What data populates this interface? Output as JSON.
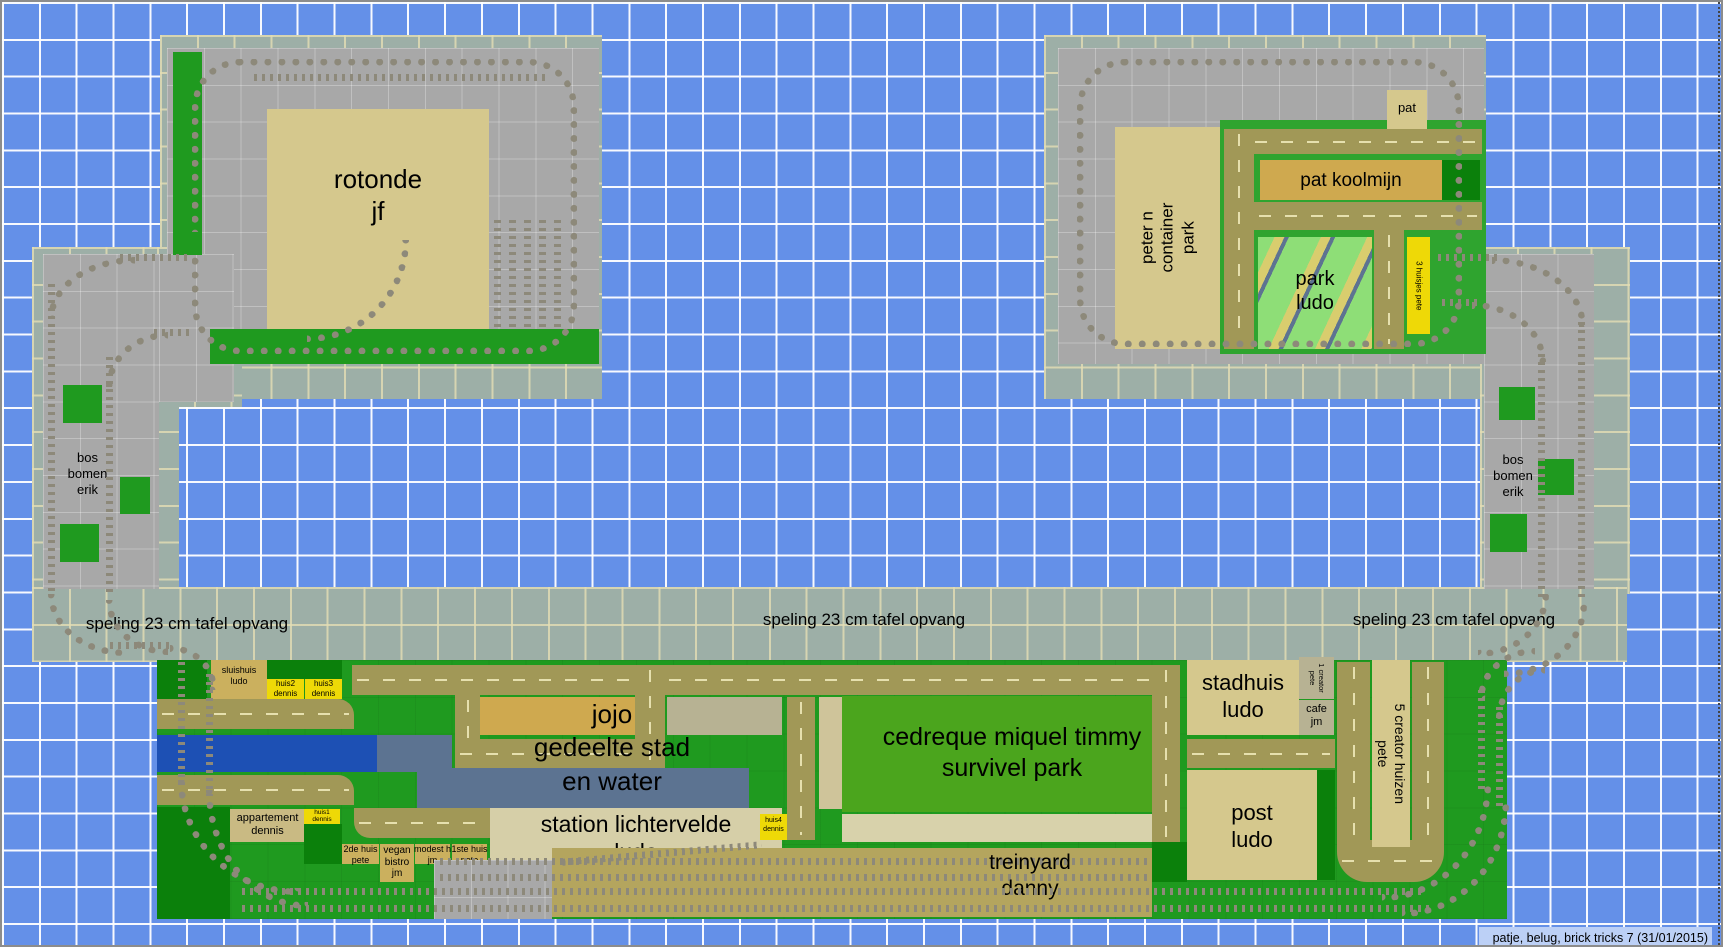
{
  "app": {
    "name": "train layout plan",
    "footer_note": "patje, belug, brick tricks 7 (31/01/2015)"
  },
  "labels": {
    "rotonde": "rotonde\njf",
    "pat": "pat",
    "pat_koolmijn": "pat koolmijn",
    "park_ludo": "park\nludo",
    "peter_container": "peter n\ncontainer\npark",
    "huisjes3_pete": "3 huisjes pete",
    "bos_bomen_erik": "bos\nbomen\nerik",
    "speling": "speling 23 cm tafel opvang",
    "sluishuis": "sluishuis\nludo",
    "huis2": "huis2\ndennis",
    "huis3": "huis3\ndennis",
    "jojo": "jojo\ngedeelte stad\nen water",
    "nick_marktplein": "nick\nmarktplein\nbrabo",
    "cedreque": "cedreque miquel timmy\nsurvivel park",
    "stadhuis": "stadhuis\nludo",
    "creator1": "1 creator\npete",
    "cafe": "cafe\njm",
    "creator5": "5 creator huizen\npete",
    "post": "post\nludo",
    "appartement": "appartement\ndennis",
    "huis1": "huis1\ndennis",
    "huis_2de": "2de huis\npete",
    "vegan": "vegan\nbistro\njm",
    "modest": "modest h\njm",
    "huis_1ste": "1ste huis\npete",
    "station": "station lichtervelde\nludo",
    "huis4": "huis4\ndennis",
    "treinyard": "treinyard\ndanny"
  },
  "colors": {
    "background_blue": "#6490e8",
    "grid_line": "#ffffff",
    "table_overlay_sage": "#9dafa7",
    "baseplate_gray": "#a8a8a8",
    "green": "#1f9a1f",
    "green_bright": "#2fa42f",
    "green_dark": "#0b800b",
    "park_green": "#4ba51d",
    "tan": "#d5c88d",
    "tan_orange": "#cfa94f",
    "tan_small": "#cbb05e",
    "label_yellow": "#eed907",
    "water_blue": "#1d50b4",
    "water_slate": "#5c7391",
    "road_olive": "#a19857",
    "track_gray": "#8d897a",
    "footer_bg": "#bcd0f6"
  }
}
